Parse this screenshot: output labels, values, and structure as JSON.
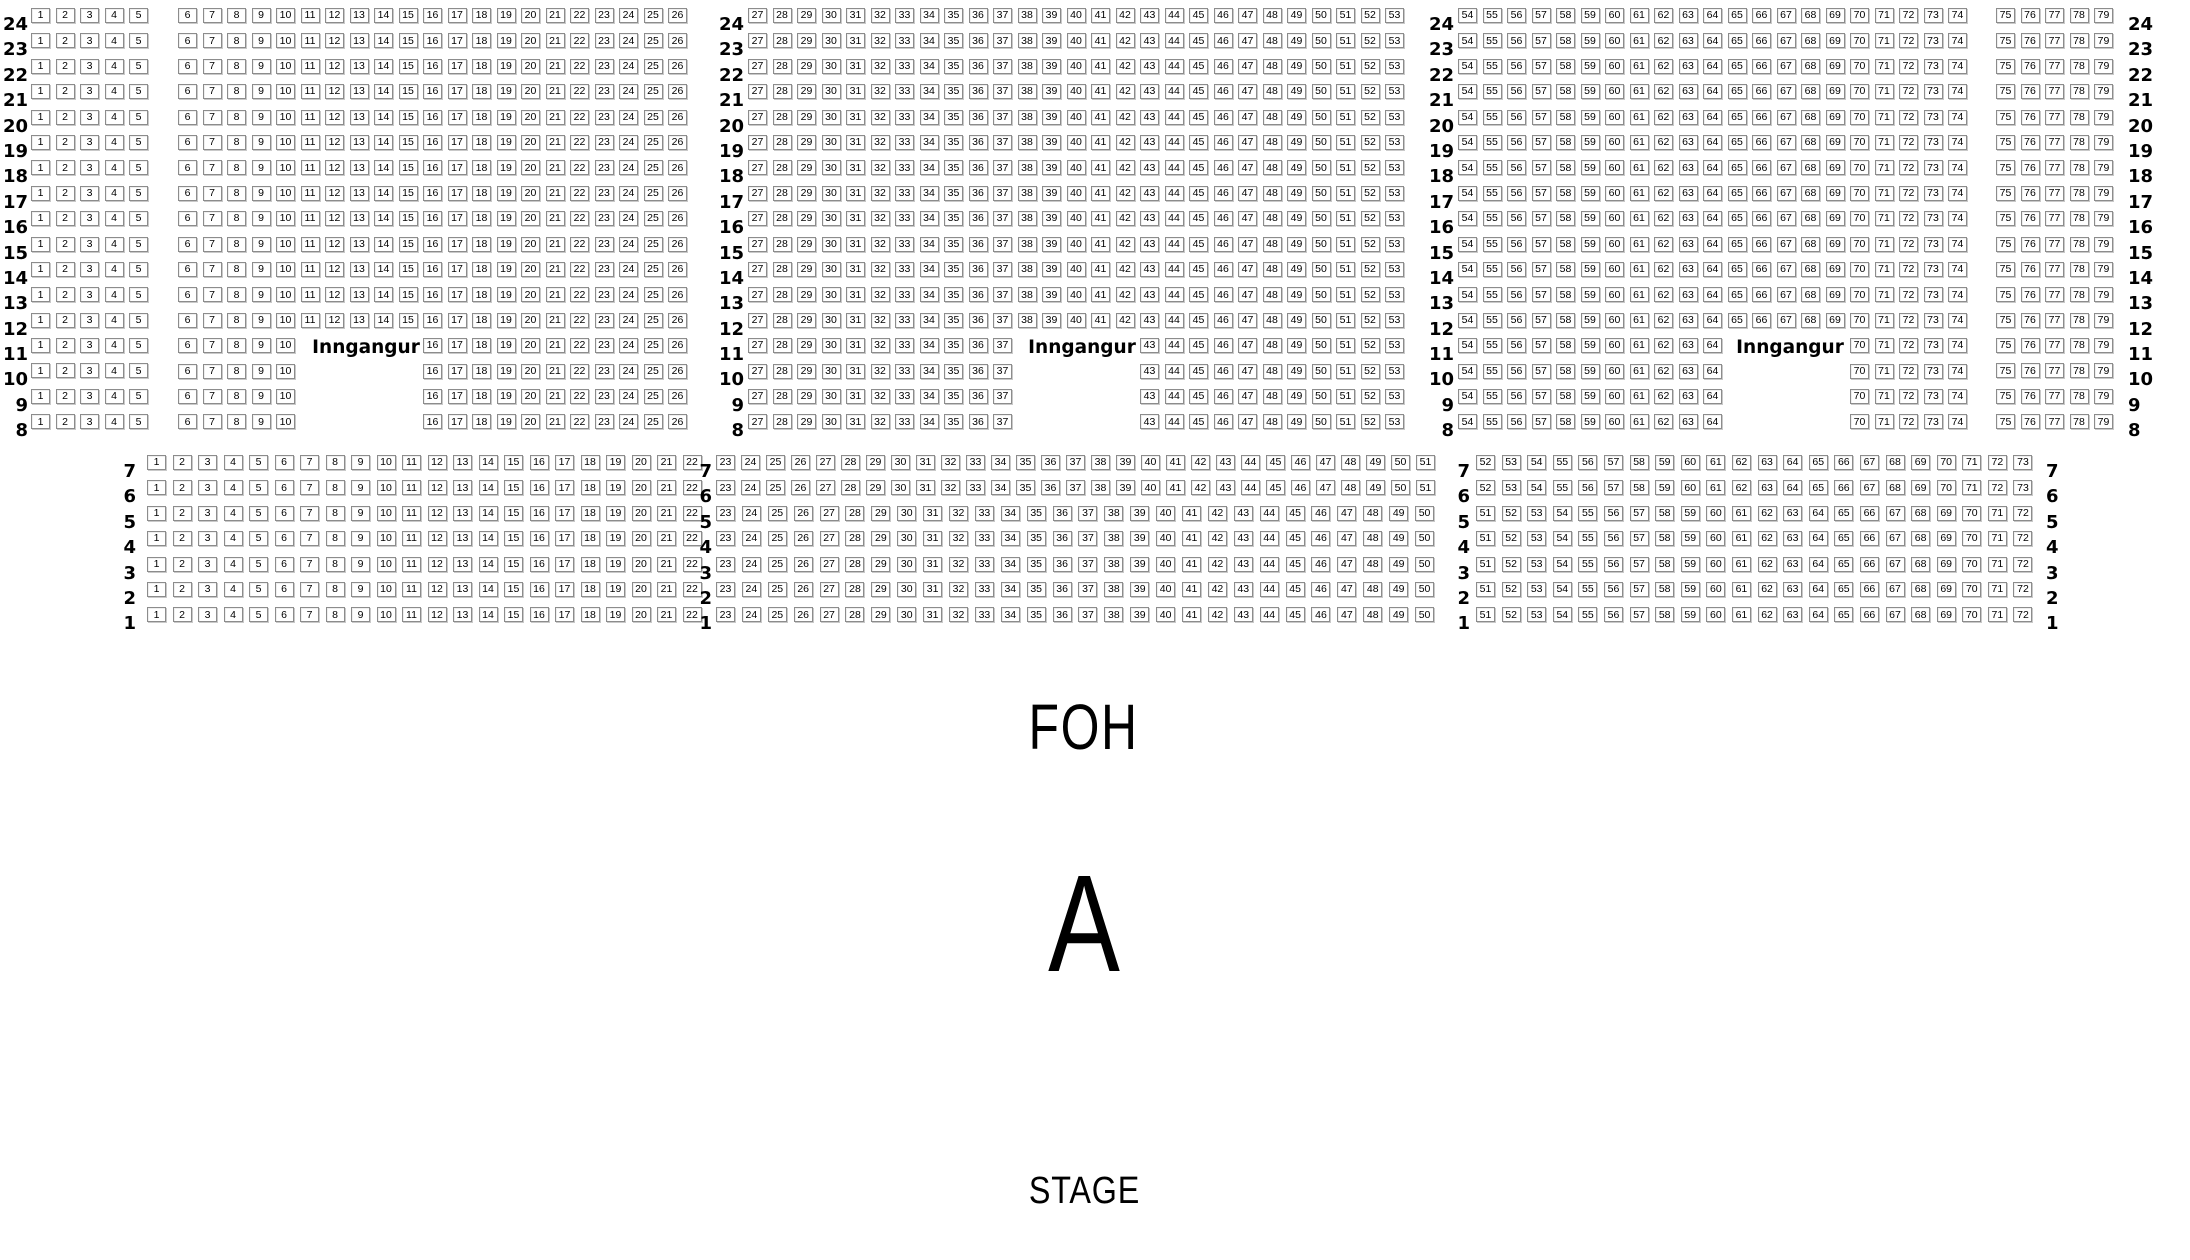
{
  "texts": {
    "foh": "FOH",
    "section_letter": "A",
    "stage": "STAGE"
  },
  "seatmap": {
    "background": "#ffffff",
    "seat_box": {
      "width": 19,
      "height": 15,
      "fill": "#ffffff",
      "border_color": "#8c8c8c",
      "text_color": "#000000"
    },
    "row_pitch": 25.4,
    "rear_rows": [
      24,
      23,
      22,
      21,
      20,
      19,
      18,
      17,
      16,
      15,
      14,
      13,
      12,
      11,
      10,
      9,
      8
    ],
    "front_rows": [
      7,
      6,
      5,
      4,
      3,
      2,
      1
    ],
    "blocks": [
      {
        "x": 31,
        "y": 8,
        "rows": 17,
        "start": 1,
        "end": 5,
        "pitch": 24.5
      },
      {
        "x": 178,
        "y": 8,
        "rows": 13,
        "start": 6,
        "end": 26,
        "pitch": 24.5
      },
      {
        "x": 178,
        "y": 338.2,
        "rows": 4,
        "start": 6,
        "end": 10,
        "pitch": 24.5
      },
      {
        "x": 423,
        "y": 338.2,
        "rows": 4,
        "start": 16,
        "end": 26,
        "pitch": 24.5
      },
      {
        "x": 748,
        "y": 8,
        "rows": 13,
        "start": 27,
        "end": 53,
        "pitch": 24.5
      },
      {
        "x": 748,
        "y": 338.2,
        "rows": 4,
        "start": 27,
        "end": 37,
        "pitch": 24.5
      },
      {
        "x": 1140,
        "y": 338.2,
        "rows": 4,
        "start": 43,
        "end": 53,
        "pitch": 24.5
      },
      {
        "x": 1458,
        "y": 8,
        "rows": 13,
        "start": 54,
        "end": 74,
        "pitch": 24.5
      },
      {
        "x": 1458,
        "y": 338.2,
        "rows": 4,
        "start": 54,
        "end": 64,
        "pitch": 24.5
      },
      {
        "x": 1850,
        "y": 338.2,
        "rows": 4,
        "start": 70,
        "end": 74,
        "pitch": 24.5
      },
      {
        "x": 1996,
        "y": 8,
        "rows": 17,
        "start": 75,
        "end": 79,
        "pitch": 24.5
      },
      {
        "x": 147,
        "y": 455,
        "rows": 7,
        "start": 1,
        "end": 22,
        "pitch": 25.5
      },
      {
        "x": 716,
        "y": 455,
        "rows": 2,
        "start": 23,
        "end": 51,
        "pitch": 25.0
      },
      {
        "x": 716,
        "y": 505.8,
        "rows": 5,
        "start": 23,
        "end": 50,
        "pitch": 25.9
      },
      {
        "x": 1476,
        "y": 455,
        "rows": 2,
        "start": 52,
        "end": 73,
        "pitch": 25.6
      },
      {
        "x": 1476,
        "y": 505.8,
        "rows": 5,
        "start": 51,
        "end": 72,
        "pitch": 25.6
      }
    ],
    "label_columns": [
      {
        "x": 2,
        "y": 8,
        "w": 26,
        "align": "right",
        "rows": "rear_rows"
      },
      {
        "x": 712,
        "y": 8,
        "w": 32,
        "align": "right",
        "rows": "rear_rows"
      },
      {
        "x": 1422,
        "y": 8,
        "w": 32,
        "align": "right",
        "rows": "rear_rows"
      },
      {
        "x": 2128,
        "y": 8,
        "w": 32,
        "align": "left",
        "rows": "rear_rows"
      },
      {
        "x": 108,
        "y": 455,
        "w": 28,
        "align": "right",
        "rows": "front_rows"
      },
      {
        "x": 686,
        "y": 455,
        "w": 26,
        "align": "right",
        "rows": "front_rows"
      },
      {
        "x": 1444,
        "y": 455,
        "w": 26,
        "align": "right",
        "rows": "front_rows"
      },
      {
        "x": 2046,
        "y": 455,
        "w": 32,
        "align": "left",
        "rows": "front_rows"
      }
    ],
    "entrances": [
      {
        "label": "Inngangur",
        "cx": 366,
        "y": 338
      },
      {
        "label": "Inngangur",
        "cx": 1082,
        "y": 338
      },
      {
        "label": "Inngangur",
        "cx": 1790,
        "y": 338
      }
    ]
  }
}
